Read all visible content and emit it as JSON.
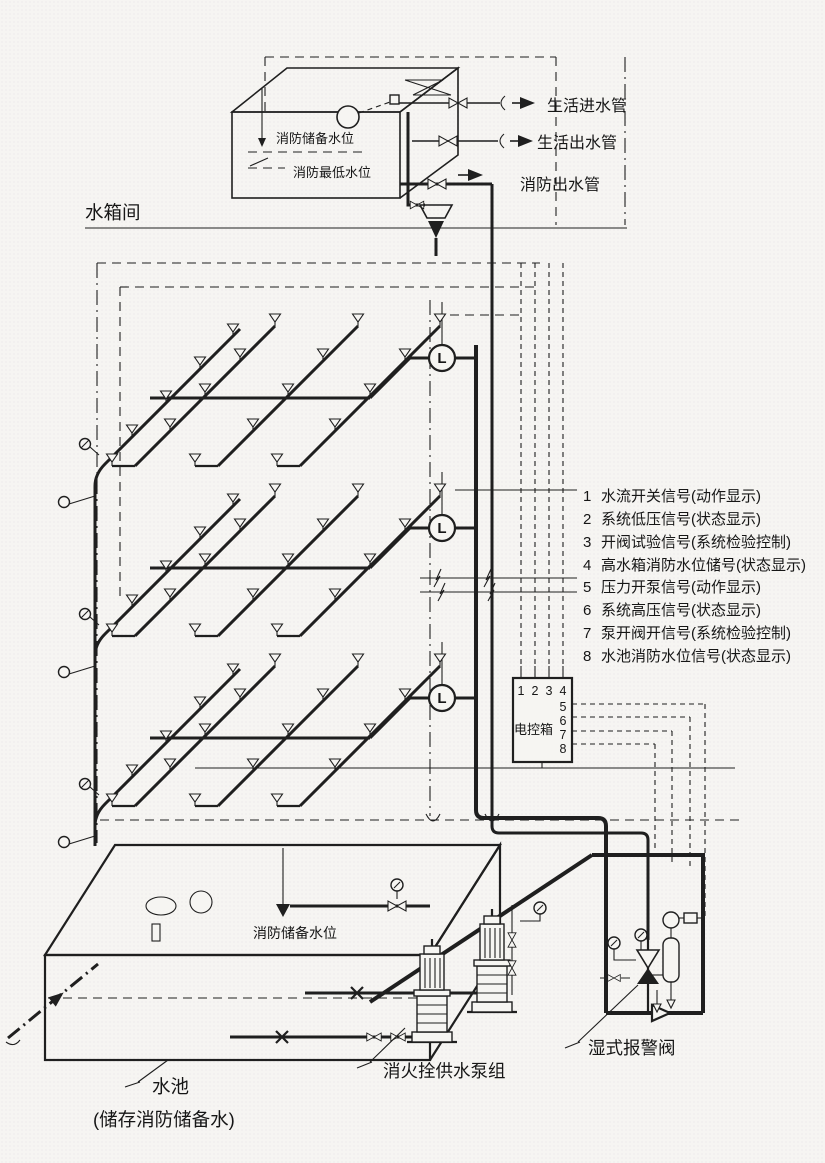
{
  "tank_room_label": "水箱间",
  "tank": {
    "reserve_level": "消防储备水位",
    "min_level": "消防最低水位"
  },
  "pipes": {
    "domestic_inlet": "生活进水管",
    "domestic_outlet": "生活出水管",
    "fire_outlet": "消防出水管"
  },
  "flow_switch_label": "L",
  "signals": {
    "items": [
      {
        "num": "1",
        "text": "水流开关信号(动作显示)"
      },
      {
        "num": "2",
        "text": "系统低压信号(状态显示)"
      },
      {
        "num": "3",
        "text": "开阀试验信号(系统检验控制)"
      },
      {
        "num": "4",
        "text": "高水箱消防水位储号(状态显示)"
      },
      {
        "num": "5",
        "text": "压力开泵信号(动作显示)"
      },
      {
        "num": "6",
        "text": "系统高压信号(状态显示)"
      },
      {
        "num": "7",
        "text": "泵开阀开信号(系统检验控制)"
      },
      {
        "num": "8",
        "text": "水池消防水位信号(状态显示)"
      }
    ]
  },
  "control_box": {
    "label": "电控箱",
    "top_terminals": [
      "1",
      "2",
      "3",
      "4"
    ],
    "side_terminals": [
      "5",
      "6",
      "7",
      "8"
    ]
  },
  "pool": {
    "label": "水池",
    "note": "(储存消防储备水)",
    "reserve_level": "消防储备水位"
  },
  "pump_group_label": "消火拴供水泵组",
  "alarm_valve_label": "湿式报警阀",
  "colors": {
    "ink": "#1f1f1f",
    "paper": "#f6f5f2"
  }
}
